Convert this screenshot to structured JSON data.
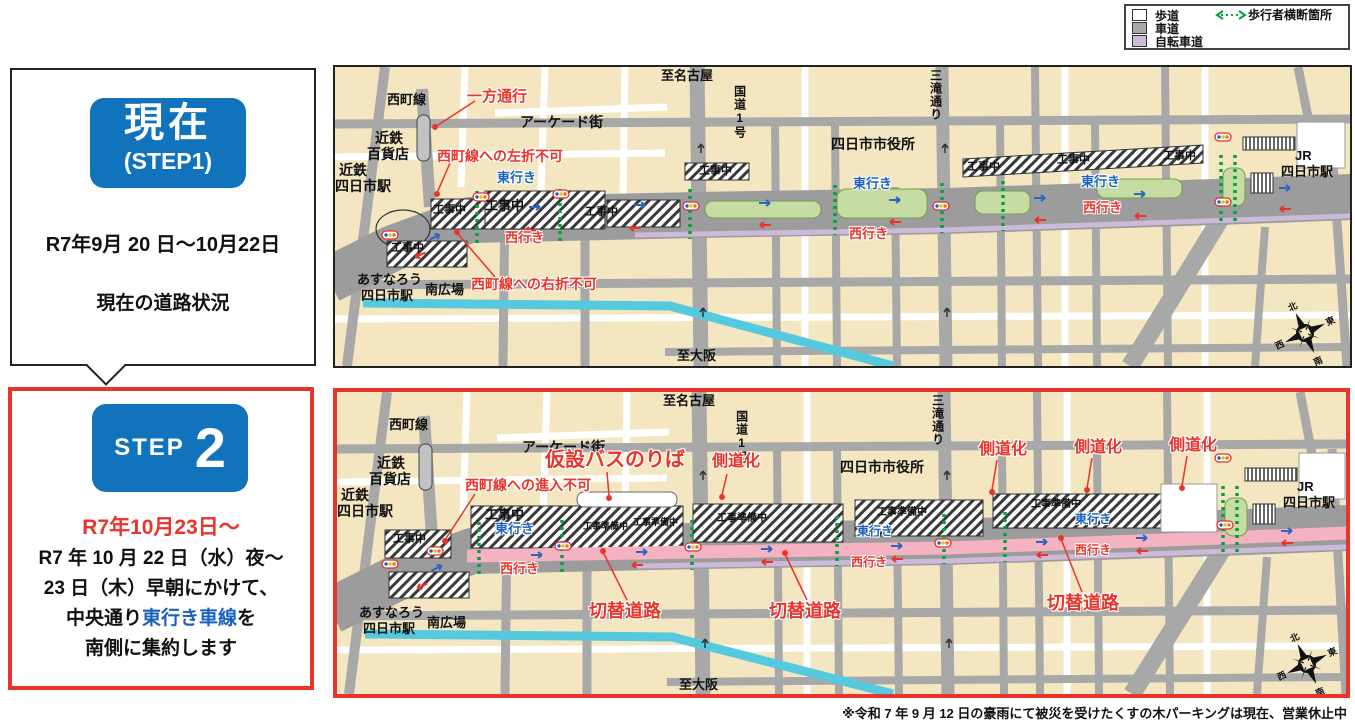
{
  "legend": {
    "items": [
      {
        "label": "歩道",
        "color": "#ffffff"
      },
      {
        "label": "車道",
        "color": "#a9a9a9"
      },
      {
        "label": "自転車道",
        "color": "#cdb9da"
      }
    ],
    "crossing_label": "歩行者横断箇所",
    "crossing_color": "#00A33C"
  },
  "step1": {
    "badge_title": "現在",
    "badge_sub": "(STEP1)",
    "period": "R7年9月 20 日～10月22日",
    "description": "現在の道路状況"
  },
  "step2": {
    "badge_step": "STEP",
    "badge_num": "2",
    "period": "R7年10月23日～",
    "line1": "R7 年 10 月 22 日（水）夜～",
    "line2": "23 日（木）早朝にかけて、",
    "line3_black": "中央通り",
    "line3_blue": "東行き車線",
    "line3_tail": "を",
    "line4": "南側に集約します"
  },
  "shared": {
    "to_nagoya": "至名古屋",
    "to_osaka": "至大阪",
    "route1": "国道1号",
    "mitaki": "三滝通り",
    "city_hall": "四日市市役所",
    "jr": "JR",
    "yokkaichi_sta": "四日市駅",
    "nishimachi_line": "西町線",
    "arcade": "アーケード街",
    "kintetsu": "近鉄",
    "dept_store": "百貨店",
    "asunarou": "あすなろう",
    "minami_plaza": "南広場",
    "eastbound": "東行き",
    "westbound": "西行き",
    "construction": "工事中",
    "compass": {
      "n": "北",
      "e": "東",
      "s": "南",
      "w": "西"
    }
  },
  "map1": {
    "one_way": "一方通行",
    "no_left_turn": "西町線への左折不可",
    "no_right_turn": "西町線への右折不可"
  },
  "map2": {
    "temp_bus_stop": "仮設バスのりば",
    "no_entry": "西町線への進入不可",
    "construction_prep": "工事準備中",
    "side_road_conversion": "側道化",
    "switch_road": "切替道路"
  },
  "footnote": "※令和 7 年 9 月 12 日の豪雨にて被災を受けたくすの木パーキングは現在、営業休止中",
  "colors": {
    "accent_blue": "#1173BC",
    "alert_red": "#E8342B",
    "link_blue": "#1A62BC",
    "median_green": "#C7DCA2",
    "switch_pink": "#F5B2C0",
    "bike_purple": "#CDB9DA",
    "crossing_green": "#00A33C",
    "road_gray": "#A9A9A9",
    "block_cream": "#F4E6C0",
    "canal_cyan": "#55CADE"
  }
}
